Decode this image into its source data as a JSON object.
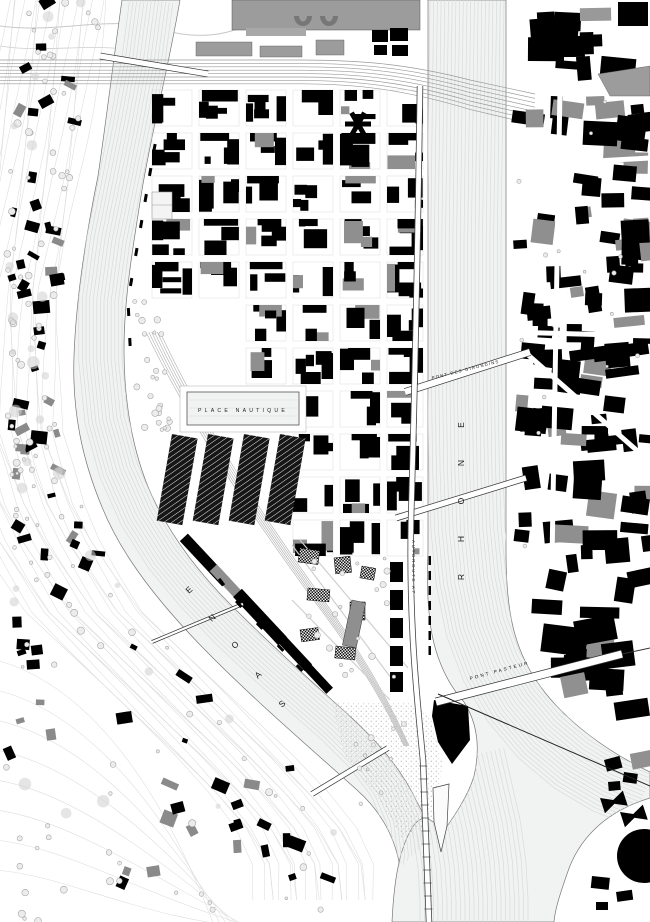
{
  "title": "Figure-ground master plan - Lyon Confluence",
  "map": {
    "type": "figure-ground-plan",
    "labels": {
      "river_right": "RHONE",
      "river_left": "SAONE",
      "basin": "PLACE NAUTIQUE",
      "bridge_mid": "PONT DES GIRONDINS",
      "bridge_south": "PONT PASTEUR",
      "highway": "AUTOROUTE A7"
    },
    "colors": {
      "ink": "#000000",
      "secondary_building": "#9c9c9c",
      "water": "#f1f2f2",
      "flow_line": "#d9dbdb",
      "contour": "#dcdcdc",
      "label": "#1a1a1a"
    }
  }
}
